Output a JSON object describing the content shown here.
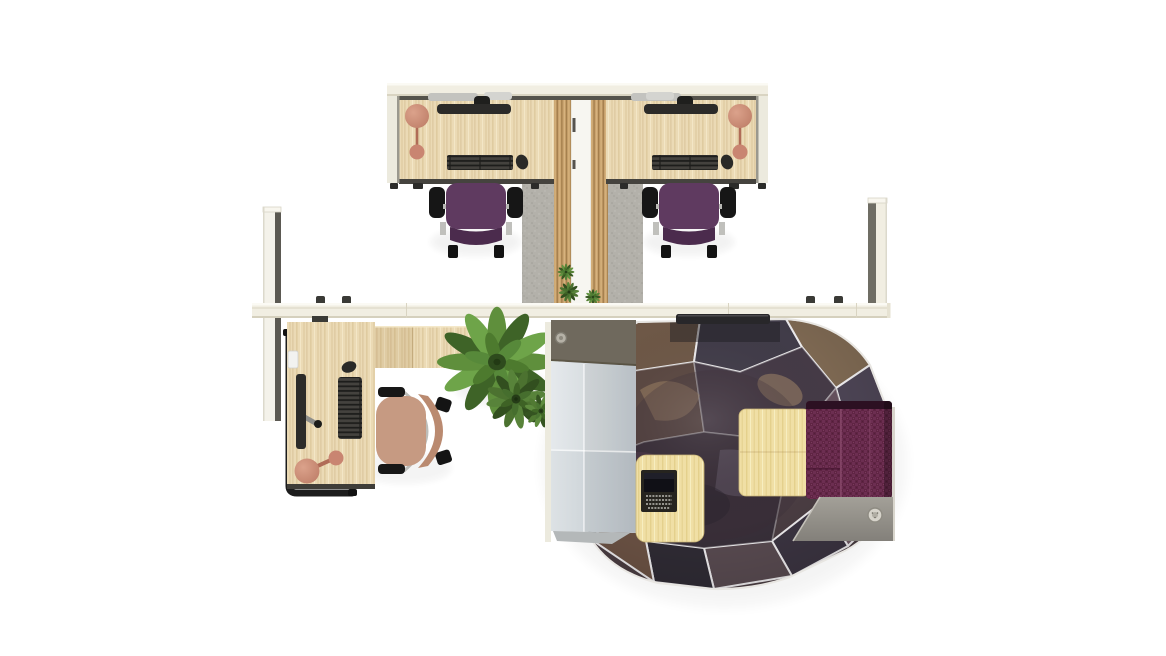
{
  "meta": {
    "title": "Top-down 3D render of an office layout: two bench workstations, a manager L-desk, a large plant and a faceted privacy pod",
    "view": "plan (top-down)",
    "canvas_width": 1166,
    "canvas_height": 656,
    "background": "#ffffff"
  },
  "colors": {
    "wall_cream": "#f1eee2",
    "wall_highlight": "#fbfaf4",
    "wall_line": "#d9d4c2",
    "wall_edge_dark": "#66645c",
    "screen_white": "#eceade",
    "desk_wood": "#ebdab5",
    "desk_wood_line": "#dcc69e",
    "slat_wood": "#c9a26d",
    "slat_line": "#a37e4c",
    "floor_gray": "#b3b1aa",
    "desk_edge": "#45433e",
    "monitor_dark": "#2c2b29",
    "keyboard_dark": "#1d1d1b",
    "silver": "#c3c3bf",
    "lamp_salmon": "#c98571",
    "lamp_deep": "#b06c57",
    "chair_purple": "#5f3a60",
    "chair_purple_dark": "#4b2b4d",
    "chair_black": "#161616",
    "chair_tan": "#c69a82",
    "chair_tan_dark": "#ba8a70",
    "plant_green": "#5f8f3c",
    "plant_green_dark": "#3e6327",
    "plant_center": "#2e4b1d",
    "pod_panel_dark": "#6f695d",
    "pod_panel_light_a": "#e0e4e7",
    "pod_panel_light_b": "#c9d0d5",
    "pod_table_wood": "#f0dfa5",
    "bench_plum": "#5f2443",
    "bench_edge": "#2c1022",
    "platform_gray": "#8f8c84",
    "facet_line": "#eceaec",
    "laptop_dark": "#26241f",
    "vent_dark": "#28272a"
  },
  "pod": {
    "facet_fills": [
      "#6e5847",
      "#413c49",
      "#7d6852",
      "#4c4454",
      "#6f5a64",
      "#3b3441",
      "#584a50",
      "#2f2b34",
      "#6b5244",
      "#4a414d",
      "#7c6654",
      "#585064",
      "#5a4741",
      "#453a46",
      "#64505c",
      "#382f39"
    ]
  },
  "objects": [
    {
      "id": "workstation-a",
      "type": "desk",
      "position": "top-left",
      "items": [
        "monitor on arm",
        "keyboard",
        "mouse",
        "desk-lamp"
      ],
      "chair": "purple task chair"
    },
    {
      "id": "workstation-b",
      "type": "desk",
      "position": "top-right",
      "items": [
        "monitor on arm",
        "keyboard",
        "mouse",
        "desk-lamp"
      ],
      "chair": "purple task chair"
    },
    {
      "id": "manager-workstation",
      "type": "l-shaped desk with credenza return",
      "position": "left",
      "items": [
        "monitor",
        "keyboard",
        "mouse",
        "desk-lamp",
        "cpu-holder"
      ],
      "chair": "tan task chair"
    },
    {
      "id": "privacy-pod",
      "type": "faceted dome pod",
      "position": "right",
      "items": [
        "plum bench",
        "large wood table",
        "laptop table",
        "open laptop",
        "entry panels",
        "roof vent",
        "platform with button"
      ]
    },
    {
      "id": "plant-large",
      "type": "potted plant",
      "position": "center"
    },
    {
      "id": "plant-small",
      "type": "potted plant",
      "position": "center"
    },
    {
      "id": "walls",
      "segments": [
        "top wall",
        "horizontal spine wall",
        "vertical wall left",
        "vertical wall right",
        "center divider",
        "slat wall left",
        "slat wall right"
      ]
    }
  ]
}
